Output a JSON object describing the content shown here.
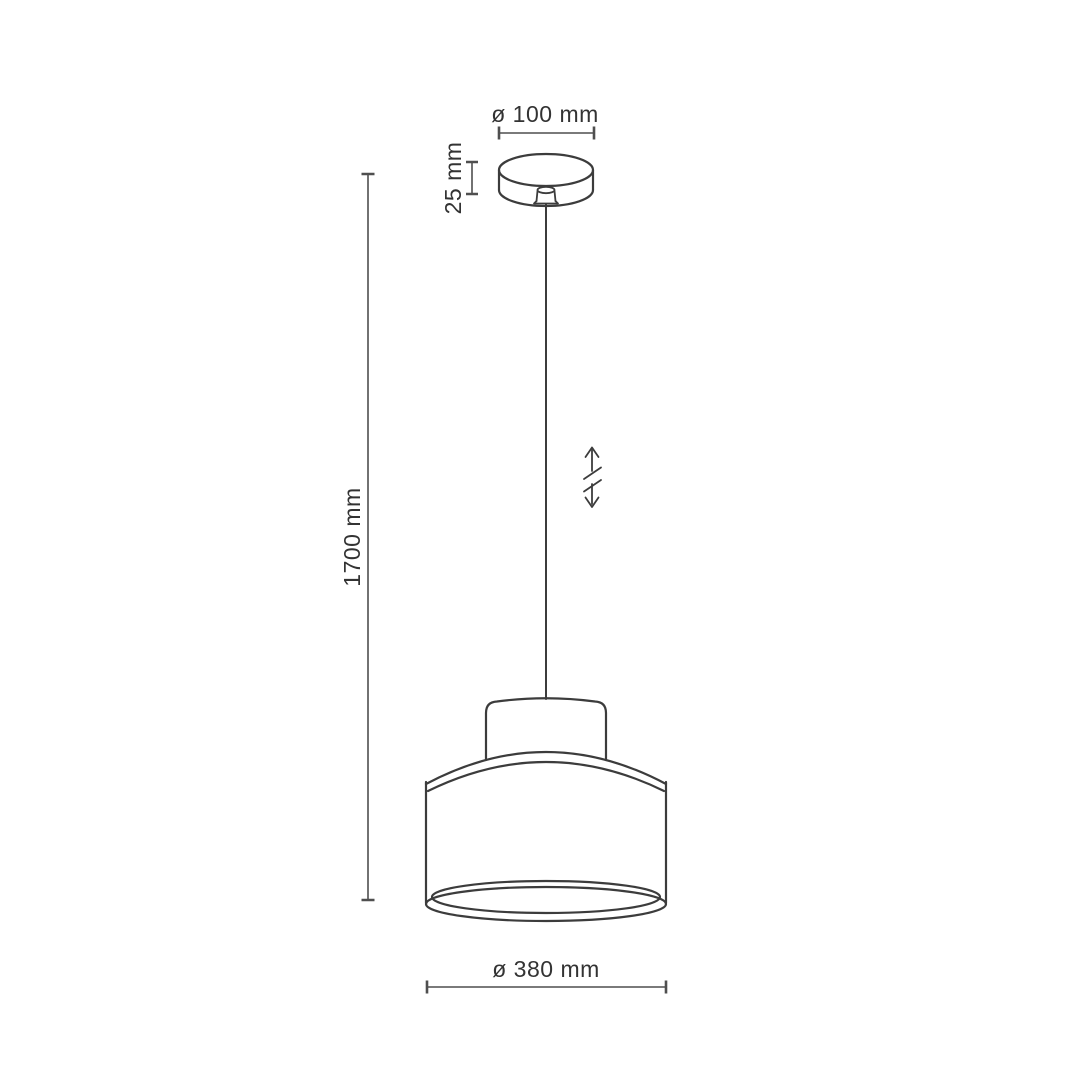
{
  "figure": {
    "title": "Pendant lamp dimension diagram",
    "type": "technical-drawing"
  },
  "colors": {
    "background": "#ffffff",
    "drawing_line": "#3c3c3c",
    "dimension_line": "#4f4f4f",
    "text_color": "#333333"
  },
  "dimensions": {
    "canopy_diameter": "ø 100 mm",
    "canopy_height": "25 mm",
    "suspension_length": "1700 mm",
    "shade_diameter": "ø 380 mm"
  },
  "icons": {
    "adjustable_height": "vertical-double-arrow-with-break"
  }
}
